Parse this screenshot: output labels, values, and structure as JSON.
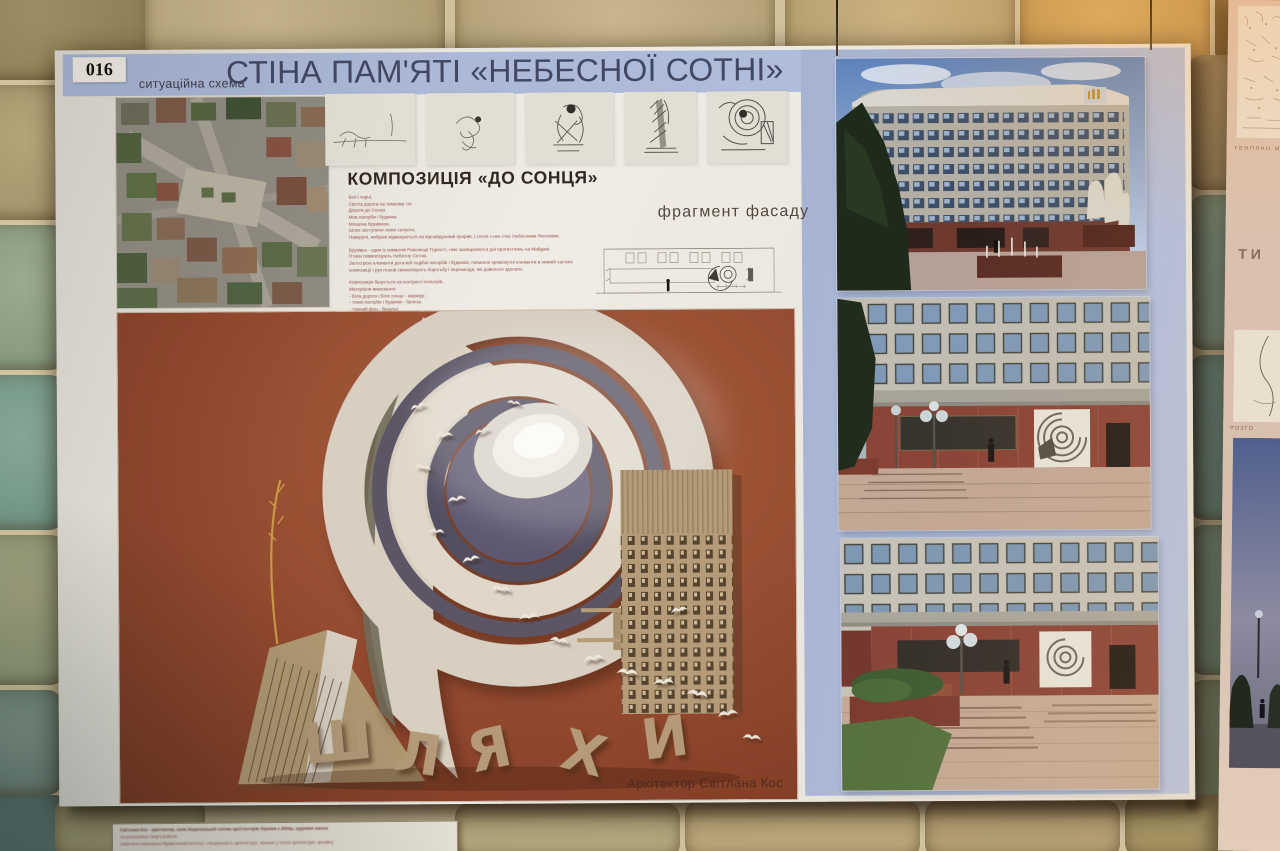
{
  "poster": {
    "number": "016",
    "title": "СТІНА ПАМ'ЯТІ «НЕБЕСНОЇ СОТНІ»",
    "situational_scheme_label": "ситуаційна схема",
    "composition_heading": "КОМПОЗИЦІЯ «ДО СОНЦЯ»",
    "facade_fragment_label": "фрагмент фасаду",
    "architect_credit": "Архітектор Світлана Кос",
    "model_letters": "ШЛЯХИ",
    "description_paragraph_1": [
      "Білі і чорні.",
      "Світла дорога на темному тлі.",
      "Дорога до Сонця.",
      "Мов пагорби і будинки.",
      "Мощена бруківкою.",
      "Шлях заступили темні силуети,",
      "Навкруги, вибрані відважуються на відчайдушний прорив, і сотня з них стає Небесними Янголами."
    ],
    "description_paragraph_2": [
      "Бруківка - один із символів Революції Гідності, нею захищалися в дні протистоянь на Майдані.",
      "Птахи символізують Небесну Сотню.",
      "Загострені елементи деталей подібні пагорбів і будинків, повалені прямокутні елементи в нижній частині",
      "композиції і рух птахів символізують боротьбу і перешкоди, які довелося здолати."
    ],
    "description_paragraph_3": [
      "Композиція базується на контрасті кольорів.",
      "Матеріали виконання:",
      "- Біла дорога і Біле сонце - мармур ;",
      "- темні пагорби і будинки - бронза.",
      "- темний фон - базальт.",
      "На чорній плиті із базальту викарбувані імена героїв Небесної Сотні.",
      "Пропонується виконати підсвітку по всій довжині стіни."
    ],
    "caption_card_lines": [
      "Світлана Кос - архітектор, член Національної спілки архітекторів України з 2004р, художня школа",
      "та реалізовані творчі роботи.",
      "Закінчила інженерно-будівельний інститут, спеціальність архітектура, працює у галузі архітектури, дизайну"
    ]
  },
  "right_poster": {
    "genplan_label": "ГЕНПЛАН М",
    "type_label": "ТИ",
    "rozgortka_label": "РОЗГО"
  },
  "colors": {
    "band_blue": "#aebbda",
    "title_text": "#424862",
    "poster_paper": "#eae6de",
    "model_terracotta": "#96492f",
    "body_text": "#92504a",
    "caption_text": "#8a4a40",
    "stone_tan": "#bcab7f",
    "stone_green": "#84a292"
  }
}
